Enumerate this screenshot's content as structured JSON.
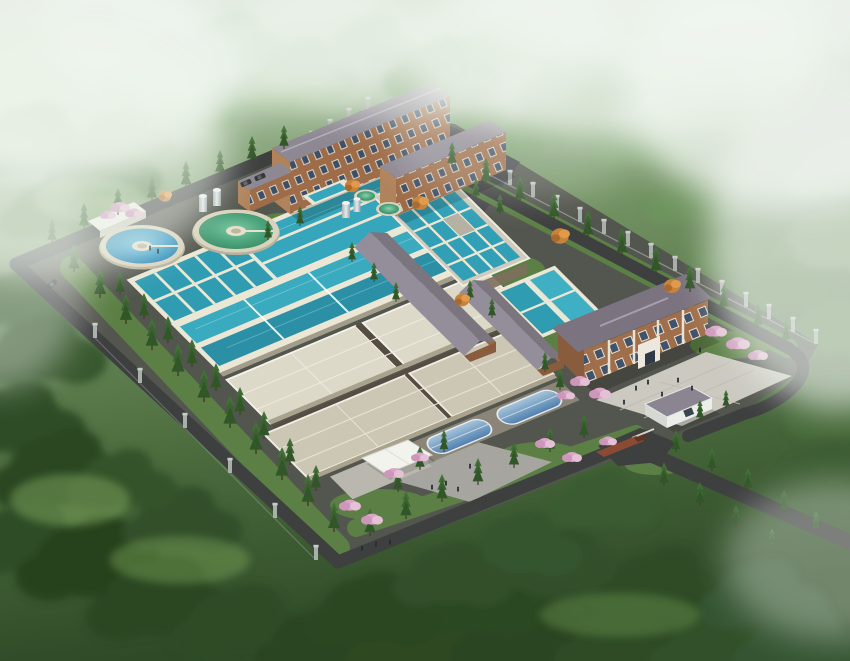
{
  "scene": {
    "type": "aerial-architectural-rendering",
    "subject": "hillside water treatment plant campus",
    "setting": "forested mountain valley with mist"
  },
  "palette": {
    "forest_dark": "#2b4521",
    "forest_mid": "#4f7440",
    "forest_light": "#7fa66d",
    "mist": "#f0f5ef",
    "road": "#3e4040",
    "platform": "#53564e",
    "grass": "#5c7f46",
    "basin_wall": "#ece7d4",
    "water_teal": "#35a6bb",
    "water_teal_dark": "#2b90a6",
    "clarifier_blue": "#3e9ec9",
    "clarifier_green": "#4ba57c",
    "roof_beige": "#ddd9c8",
    "roof_beige_dark": "#ccc7b5",
    "brick": "#9e6c48",
    "roof_gray": "#8e8893",
    "plaza": "#cbc9c0",
    "glass_blue": "#6b94bc",
    "canopy": "#f3f3ee",
    "truck": "#8a4a34",
    "bloom_pink": "#dcaac9",
    "autumn": "#c8823c",
    "tank_silver": "#c9ced1",
    "pillar": "#a9afaa",
    "people": "#272c33"
  },
  "structures": {
    "wall_pillars": [
      [
        312,
        146
      ],
      [
        330,
        134
      ],
      [
        349,
        123
      ],
      [
        368,
        112
      ],
      [
        392,
        124
      ],
      [
        415,
        136
      ],
      [
        439,
        149
      ],
      [
        462,
        161
      ],
      [
        486,
        173
      ],
      [
        510,
        185
      ],
      [
        533,
        197
      ],
      [
        557,
        210
      ],
      [
        580,
        222
      ],
      [
        604,
        234
      ],
      [
        628,
        246
      ],
      [
        651,
        258
      ],
      [
        675,
        271
      ],
      [
        698,
        283
      ],
      [
        722,
        295
      ],
      [
        746,
        307
      ],
      [
        769,
        319
      ],
      [
        793,
        332
      ],
      [
        816,
        344
      ],
      [
        95,
        338
      ],
      [
        140,
        383
      ],
      [
        185,
        428
      ],
      [
        230,
        473
      ],
      [
        275,
        518
      ],
      [
        316,
        560
      ]
    ]
  },
  "vegetation": {
    "conifers": [
      [
        52,
        243,
        24
      ],
      [
        84,
        229,
        26
      ],
      [
        118,
        215,
        27
      ],
      [
        152,
        201,
        26
      ],
      [
        186,
        188,
        27
      ],
      [
        220,
        175,
        25
      ],
      [
        252,
        162,
        26
      ],
      [
        284,
        149,
        24
      ],
      [
        74,
        272,
        28
      ],
      [
        100,
        298,
        30
      ],
      [
        126,
        324,
        31
      ],
      [
        152,
        350,
        32
      ],
      [
        178,
        376,
        33
      ],
      [
        204,
        402,
        33
      ],
      [
        230,
        428,
        33
      ],
      [
        256,
        454,
        33
      ],
      [
        282,
        480,
        33
      ],
      [
        308,
        506,
        32
      ],
      [
        334,
        532,
        30
      ],
      [
        120,
        295,
        24
      ],
      [
        144,
        319,
        26
      ],
      [
        168,
        343,
        27
      ],
      [
        192,
        367,
        28
      ],
      [
        216,
        391,
        28
      ],
      [
        240,
        415,
        28
      ],
      [
        264,
        439,
        28
      ],
      [
        290,
        465,
        27
      ],
      [
        316,
        491,
        26
      ],
      [
        452,
        166,
        24
      ],
      [
        486,
        184,
        26
      ],
      [
        520,
        202,
        26
      ],
      [
        554,
        220,
        28
      ],
      [
        588,
        238,
        28
      ],
      [
        622,
        256,
        28
      ],
      [
        656,
        274,
        28
      ],
      [
        690,
        292,
        27
      ],
      [
        724,
        310,
        26
      ],
      [
        758,
        328,
        25
      ],
      [
        786,
        342,
        22
      ],
      [
        370,
        536,
        28
      ],
      [
        406,
        519,
        28
      ],
      [
        442,
        502,
        28
      ],
      [
        478,
        485,
        27
      ],
      [
        514,
        468,
        26
      ],
      [
        550,
        452,
        25
      ],
      [
        584,
        438,
        24
      ],
      [
        676,
        452,
        22
      ],
      [
        712,
        471,
        23
      ],
      [
        748,
        491,
        23
      ],
      [
        784,
        512,
        22
      ],
      [
        816,
        531,
        20
      ],
      [
        664,
        486,
        24
      ],
      [
        700,
        506,
        24
      ],
      [
        736,
        527,
        22
      ],
      [
        772,
        548,
        20
      ],
      [
        470,
        300,
        20
      ],
      [
        492,
        318,
        20
      ],
      [
        352,
        262,
        20
      ],
      [
        374,
        282,
        20
      ],
      [
        396,
        302,
        20
      ],
      [
        560,
        390,
        22
      ],
      [
        545,
        372,
        20
      ],
      [
        420,
        470,
        24
      ],
      [
        444,
        452,
        22
      ],
      [
        398,
        492,
        24
      ],
      [
        300,
        226,
        20
      ],
      [
        268,
        240,
        20
      ],
      [
        476,
        198,
        20
      ],
      [
        500,
        214,
        20
      ],
      [
        700,
        420,
        20
      ],
      [
        726,
        408,
        18
      ]
    ],
    "forest": [
      [
        20,
        60,
        2.6,
        "#9db98e",
        0.9
      ],
      [
        90,
        30,
        2.2,
        "#8fb083",
        0.9
      ],
      [
        160,
        70,
        2.8,
        "#7ea371",
        0.9
      ],
      [
        230,
        40,
        2.2,
        "#88ad7c",
        0.85
      ],
      [
        300,
        70,
        2.4,
        "#759c67",
        0.9
      ],
      [
        370,
        40,
        2.0,
        "#83a876",
        0.85
      ],
      [
        440,
        70,
        2.6,
        "#6f975f",
        0.9
      ],
      [
        510,
        40,
        2.2,
        "#7ba46c",
        0.8
      ],
      [
        580,
        80,
        2.8,
        "#6f9a61",
        0.9
      ],
      [
        650,
        50,
        2.4,
        "#7fa873",
        0.85
      ],
      [
        720,
        90,
        2.6,
        "#749c66",
        0.9
      ],
      [
        790,
        60,
        2.4,
        "#86ab79",
        0.85
      ],
      [
        830,
        110,
        2.2,
        "#7da26f",
        0.85
      ],
      [
        30,
        140,
        3.0,
        "#5d8450",
        0.95
      ],
      [
        100,
        170,
        2.6,
        "#527947",
        0.95
      ],
      [
        50,
        210,
        2.4,
        "#618852",
        0.9
      ],
      [
        120,
        135,
        2.2,
        "#6b9159",
        0.9
      ],
      [
        190,
        108,
        2.0,
        "#7aa46c",
        0.85
      ],
      [
        260,
        90,
        1.8,
        "#85ad77",
        0.85
      ],
      [
        15,
        300,
        2.4,
        "#3f6234",
        1
      ],
      [
        40,
        350,
        2.8,
        "#38592e",
        1
      ],
      [
        15,
        420,
        3.0,
        "#2f4d27",
        1
      ],
      [
        60,
        470,
        3.2,
        "#2b4724",
        1
      ],
      [
        25,
        540,
        3.0,
        "#2f4d28",
        1
      ],
      [
        90,
        560,
        3.4,
        "#27421f",
        1
      ],
      [
        160,
        600,
        3.4,
        "#2b4722",
        1
      ],
      [
        240,
        625,
        3.2,
        "#2f4c26",
        1
      ],
      [
        320,
        645,
        3.0,
        "#2a4521",
        1
      ],
      [
        420,
        645,
        3.4,
        "#2e4a24",
        1
      ],
      [
        520,
        640,
        3.2,
        "#2a4420",
        1
      ],
      [
        620,
        645,
        3.0,
        "#2f4b25",
        1
      ],
      [
        720,
        648,
        3.2,
        "#33512a",
        1
      ],
      [
        800,
        645,
        3.0,
        "#365530",
        1
      ],
      [
        560,
        565,
        2.8,
        "#31502a",
        1
      ],
      [
        660,
        585,
        3.0,
        "#2e4b26",
        1
      ],
      [
        760,
        595,
        2.8,
        "#365431",
        1
      ],
      [
        470,
        600,
        3.0,
        "#2c4824",
        1
      ],
      [
        370,
        610,
        3.0,
        "#2c4723",
        1
      ],
      [
        180,
        520,
        2.6,
        "#30502a",
        1
      ],
      [
        120,
        480,
        2.4,
        "#345329",
        1
      ],
      [
        820,
        480,
        2.6,
        "#3c5c33",
        0.95
      ],
      [
        838,
        410,
        2.4,
        "#496c3c",
        0.9
      ],
      [
        832,
        330,
        2.4,
        "#5f8350",
        0.85
      ],
      [
        828,
        240,
        2.6,
        "#7d9d6f",
        0.8
      ],
      [
        838,
        170,
        2.4,
        "#8fae81",
        0.8
      ],
      [
        600,
        500,
        2.4,
        "#3a5c31",
        1
      ],
      [
        520,
        545,
        2.6,
        "#35552d",
        1
      ],
      [
        450,
        575,
        2.6,
        "#30502a",
        1
      ],
      [
        690,
        200,
        2.0,
        "#6f9560",
        0.8
      ],
      [
        740,
        245,
        2.2,
        "#648a54",
        0.8
      ],
      [
        782,
        285,
        2.0,
        "#5b8049",
        0.8
      ],
      [
        640,
        140,
        2.2,
        "#79a169",
        0.8
      ],
      [
        560,
        120,
        2.4,
        "#6f9a61",
        0.75
      ],
      [
        480,
        130,
        2.0,
        "#7aa26b",
        0.7
      ]
    ],
    "pink": [
      [
        120,
        206,
        1
      ],
      [
        134,
        212,
        0.9
      ],
      [
        108,
        214,
        0.8
      ],
      [
        716,
        330,
        1.1
      ],
      [
        738,
        342,
        1.2
      ],
      [
        758,
        354,
        1
      ],
      [
        580,
        380,
        1
      ],
      [
        600,
        392,
        1.1
      ],
      [
        566,
        394,
        0.9
      ],
      [
        350,
        504,
        1.1
      ],
      [
        372,
        518,
        1.1
      ],
      [
        394,
        472,
        1
      ],
      [
        420,
        456,
        0.9
      ],
      [
        545,
        442,
        1
      ],
      [
        572,
        456,
        1
      ],
      [
        608,
        440,
        0.9
      ]
    ],
    "orange": [
      [
        420,
        203,
        1
      ],
      [
        560,
        236,
        1.1
      ],
      [
        672,
        286,
        1
      ],
      [
        462,
        300,
        0.9
      ],
      [
        352,
        186,
        0.9
      ],
      [
        165,
        196,
        0.8
      ]
    ],
    "meadows": [
      [
        70,
        500,
        60,
        26,
        "#7fa65e",
        0.5
      ],
      [
        180,
        560,
        70,
        24,
        "#7aa258",
        0.45
      ],
      [
        620,
        615,
        80,
        22,
        "#6f9850",
        0.4
      ],
      [
        90,
        200,
        55,
        22,
        "#a3c18f",
        0.5
      ],
      [
        300,
        95,
        60,
        20,
        "#9dbb87",
        0.4
      ]
    ]
  },
  "figures": {
    "people": [
      [
        636,
        390
      ],
      [
        648,
        384
      ],
      [
        662,
        396
      ],
      [
        678,
        382
      ],
      [
        692,
        390
      ],
      [
        624,
        404
      ],
      [
        362,
        550
      ],
      [
        376,
        546
      ],
      [
        390,
        544
      ],
      [
        432,
        489
      ],
      [
        446,
        485
      ],
      [
        458,
        491
      ],
      [
        470,
        468
      ],
      [
        150,
        250
      ],
      [
        158,
        253
      ],
      [
        700,
        352
      ]
    ],
    "cars": [
      [
        246,
        183,
        -23
      ],
      [
        260,
        177,
        -23
      ],
      [
        52,
        284,
        -45
      ]
    ]
  },
  "atmosphere": {
    "mist": [
      [
        60,
        70,
        180,
        110,
        0.85
      ],
      [
        230,
        30,
        190,
        80,
        0.7
      ],
      [
        420,
        40,
        200,
        80,
        0.6
      ],
      [
        610,
        45,
        210,
        95,
        0.75
      ],
      [
        790,
        85,
        170,
        125,
        0.8
      ],
      [
        838,
        240,
        130,
        170,
        0.65
      ],
      [
        40,
        150,
        190,
        130,
        0.55
      ],
      [
        835,
        560,
        110,
        80,
        0.35
      ],
      [
        520,
        140,
        130,
        60,
        0.25
      ],
      [
        0,
        260,
        90,
        130,
        0.4
      ],
      [
        690,
        10,
        220,
        70,
        0.7
      ]
    ]
  }
}
